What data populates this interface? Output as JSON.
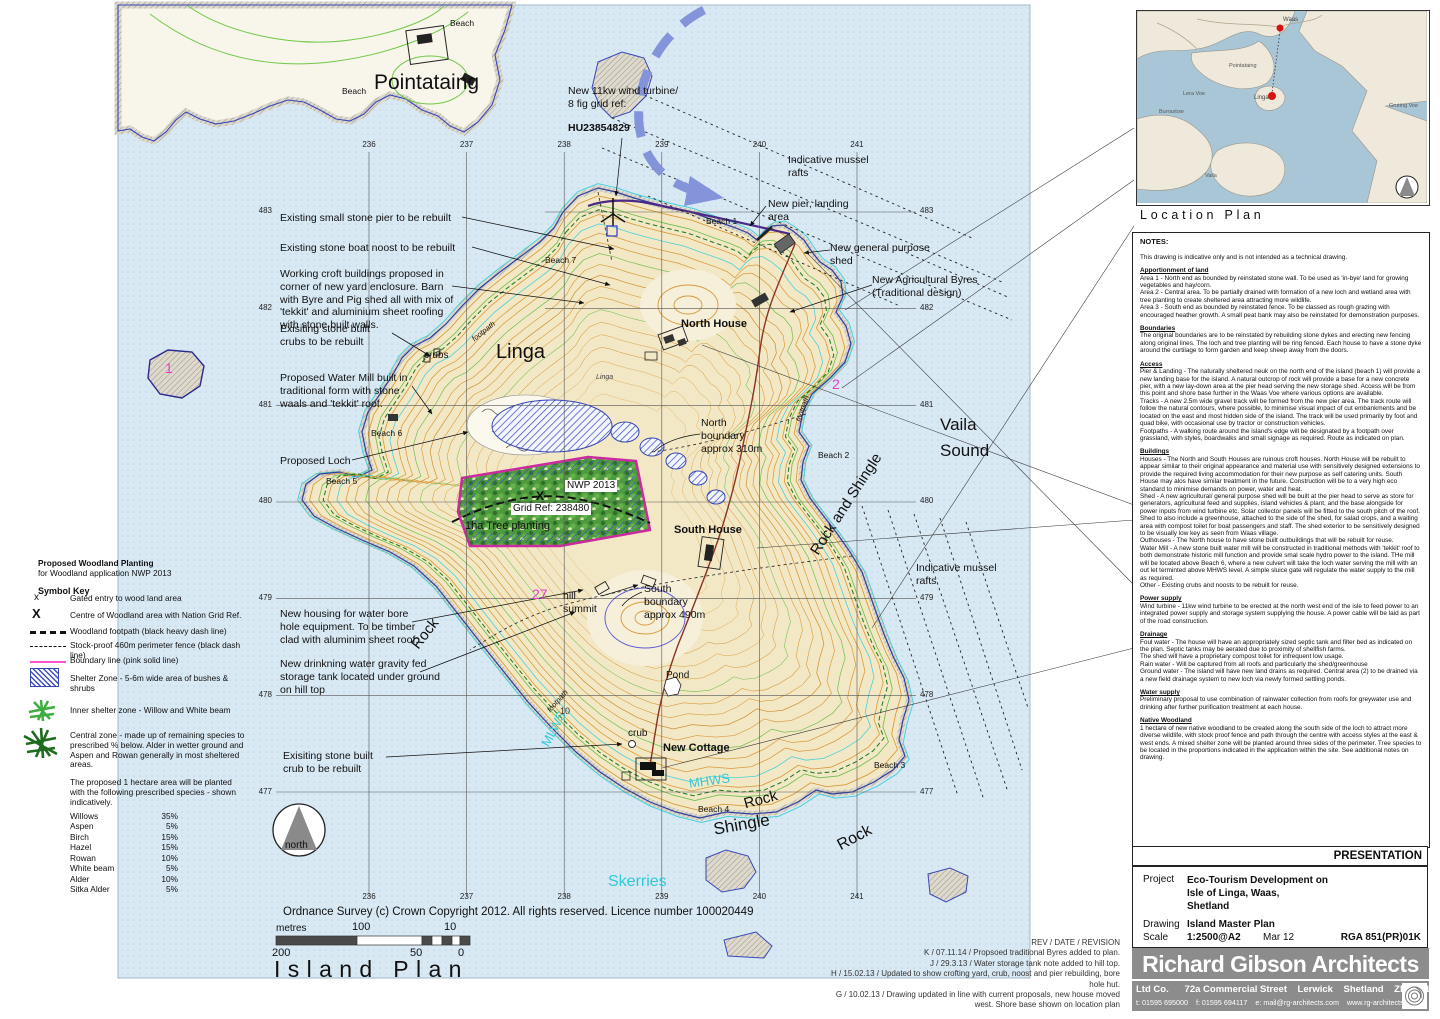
{
  "map": {
    "grid": {
      "cols": [
        "236",
        "237",
        "238",
        "239",
        "240",
        "241"
      ],
      "rows": [
        "483",
        "482",
        "481",
        "480",
        "479",
        "478",
        "477"
      ]
    },
    "labels": {
      "pier_rebuilt": "Existing small stone pier to be rebuilt",
      "noost_rebuilt": "Existing stone boat noost to be rebuilt",
      "croft_buildings": "Working croft buildings proposed in corner of new yard enclosure.  Barn with Byre and Pig shed all with mix of 'tekkit' and aluminium sheet roofing with stone built walls.",
      "crubs_rebuilt": "Exisiting stone built crubs to be rebuilt",
      "water_mill": "Proposed Water Mill built in traditional form with stone waals and 'tekkit' roof.",
      "proposed_loch": "Proposed Loch",
      "bore_hole": "New housing for water bore hole equipment. To be timber clad with aluminim sheet roof.",
      "storage_tank": "New drinkning water gravity fed storage tank located under ground on hill top",
      "crub_rebuilt": "Exisiting stone built crub to be rebuilt",
      "wind_turbine": "New 11kw wind turbine/\n8 fig grid ref:",
      "wind_turbine_ref": "HU23854829",
      "new_pier": "New pier, landing area",
      "general_shed": "New general purpose shed",
      "agri_byres": "New Agricultural  Byres\n(Traditional design)",
      "mussel_rafts": "Indicative mussel rafts",
      "pointataing": "Pointataing",
      "linga": "Linga",
      "linga_small": "Linga",
      "vaila_sound": "Vaila Sound",
      "north_house": "North House",
      "south_house": "South House",
      "new_cottage": "New Cottage",
      "north_boundary": "North boundary approx 310m",
      "south_boundary": "South boundary approx 490m",
      "hill_summit": "hill summit",
      "pond": "Pond",
      "crub": "crub",
      "crubs": "crubs",
      "beach1": "Beach 1",
      "beach2": "Beach 2",
      "beach3": "Beach 3",
      "beach4": "Beach 4",
      "beach5": "Beach 5",
      "beach6": "Beach 6",
      "beach7": "Beach 7",
      "beach": "Beach",
      "rock": "Rock",
      "shingle": "Shingle",
      "rock_shingle": "Rock and Shingle",
      "mlws": "MLWS",
      "mhws": "MHWS",
      "skerries": "Skerries",
      "footpath": "footpath",
      "num27": "27",
      "num2": "2",
      "num1": "1",
      "ten": "10",
      "nwp": "NWP 2013",
      "x_mark": "X",
      "grid_ref": "Grid Ref: 238480",
      "tree_planting": "1ha Tree planting"
    },
    "scalebar": {
      "unit": "metres",
      "m100": "100",
      "m10": "10",
      "m200": "200",
      "m50": "50",
      "m0": "0"
    },
    "compass": "north",
    "copyright": "Ordnance Survey (c) Crown Copyright 2012. All rights reserved. Licence number 100020449",
    "title": "Island Plan"
  },
  "key_block": {
    "title_l1": "Proposed Woodland Planting",
    "title_l2": "for Woodland application NWP 2013",
    "heading": "Symbol Key",
    "items": [
      {
        "sym": "x",
        "label": "Gated entry to wood land area"
      },
      {
        "sym": "X",
        "label": "Centre of Woodland area with Nation Grid Ref."
      },
      {
        "sym": "",
        "label": "Woodland footpath (black heavy dash line)"
      },
      {
        "sym": "",
        "label": "Stock-proof 460m perimeter fence (black dash line)"
      },
      {
        "sym": "",
        "label": "Boundary line (pink solid line)"
      },
      {
        "sym": "",
        "label": "Shelter Zone - 5-6m wide area of  bushes & shrubs"
      },
      {
        "sym": "",
        "label": "Inner shelter zone - Willow and White beam"
      },
      {
        "sym": "",
        "label": "Central zone - made up of remaining species to prescribed % below.  Alder in wetter ground and Aspen and Rowan generally in most sheltered areas."
      }
    ],
    "note": "The proposed  1 hectare area will be planted with the following prescribed species - shown indicatively.",
    "species": [
      {
        "name": "Willows",
        "pct": "35%"
      },
      {
        "name": "Aspen",
        "pct": "5%"
      },
      {
        "name": "Birch",
        "pct": "15%"
      },
      {
        "name": "Hazel",
        "pct": "15%"
      },
      {
        "name": "Rowan",
        "pct": "10%"
      },
      {
        "name": "White beam",
        "pct": "5%"
      },
      {
        "name": "Alder",
        "pct": "10%"
      },
      {
        "name": "Sitka Alder",
        "pct": "5%"
      }
    ]
  },
  "revisions": {
    "header": "REV  /  DATE  / REVISION",
    "lines": [
      "K / 07.11.14 / Propsoed traditional Byres added to plan.",
      "J / 29.3.13 / Water storage tank note added to hill top.",
      "H / 15.02.13 / Updated to show crofting yard, crub, noost and pier rebuilding, bore hole hut.",
      "G / 10.02.13 / Drawing updated in line with current proposals, new house moved west. Shore base shown on location plan"
    ]
  },
  "panel": {
    "location_plan": {
      "title": "Location Plan",
      "labels": {
        "waas": "Waas",
        "pointataing": "Pointataing",
        "linga": "Linga",
        "lera_voe": "Lera Voe",
        "burrastow": "Burrastow",
        "vaila": "Vaila",
        "gruting_voe": "Gruting Voe"
      }
    },
    "notes": {
      "title": "NOTES:",
      "intro": "This drawing is indicative only and is not intended as a technical drawing.",
      "sections": [
        {
          "h": "Apportionment of land",
          "b": "Area 1 - North end as bounded by reinstated stone wall.   To be used as 'in-bye' land for growing vegetables and hay/corn.\nArea 2 - Central area.  To be partially drained with formation of a new loch and wetland area with tree planting to create sheltered area attracting more wildlife.\nArea 3 - South end as bounded by reinstated fence.  To be classed as rough grazing with encouraged heather growth. A small peat bank may also be reinstated for demonstration purposes."
        },
        {
          "h": "Boundaries",
          "b": "The original boundaries are to be reinstated by rebuilding stone dykes and erecting new fencing along original lines.  The loch and tree planting will be ring fenced.  Each house to have a stone dyke around the curtilage to form garden and keep sheep away from the doors."
        },
        {
          "h": "Access",
          "b": "Pier & Landing - The naturally sheltered neuk on the north end of the island (beach 1) will provide a new landing base for the island.  A natural outcrop of rock will provide a base for a new concrete pier, with a new lay-down area at the pier head serving the new storage shed.  Access will be from this point and shore base further in the Waas Voe where various options are available.\nTracks - A new 2.5m wide gravel track will be formed from the new pier area.  The track route will follow the natural contours, where possible, to minimise visual impact of cut embankments and be located on the east and most hidden side of the island. The track will be used primarily by foot and quad bike, with occasional use by tractor or construction vehicles.\nFootpaths - A walking route around the island's edge will be designated by a footpath over grassland, with styles, boardwalks and small signage as required. Route as indicated on plan."
        },
        {
          "h": "Buildings",
          "b": "Houses - The North and South Houses are ruinous croft houses. North House will be rebuilt to appear similar to their original appearance and material use with sensitively designed extensions to provide the required living accommodation for their new purpose as self catering units.    South House may alos have similar treatment in the future.  Construction will be to a very high eco standard to minimise demands on power, water and heat.\nShed - A new agricultural/ general purpose shed will be built at the pier head to serve as store for generators, agricultural feed and supplies, island vehicles & plant,  and the base alongside for power inputs from wind turbine etc.  Solar collector panels will be fitted to the south pitch of the roof. Shed to also include  a greenhouse, attached to the side of the shed,  for salad crops, and a waiting area with compost toilet for boat passengers and staff.  The shed exterior to be  sensitively designed to be visually low key as seen from Waas village.\nOuthouses - The North house to have stone built outbuildings that will be rebuilt for reuse.\nWater Mill - A new stone built water mill will be constructed in traditional methods with 'tekkit' roof to both demonstrate historic mill function and provide smal scale hydro power to the island.  THe mill will be located above Beach 6, where a new culvert will take the loch water serving the mill with an out let terminted above MHWS level.  A simple sluice gate will regulate the water supply to the mill as required.\nOther - Existing crubs and noosts to be rebuilt for reuse."
        },
        {
          "h": "Power supply",
          "b": "Wind turbine - 11kw wind turbine to be erected at the north west end of the isle to feed power to an integrated power supply and storage system supplying the house. A power cable will be laid as part of the road construction."
        },
        {
          "h": "Drainage",
          "b": "Foul water - The house will have an appropriately sized septic tank and filter bed as indicated on the plan.   Septic tanks may be aerated due to proximity of shellfish farms.\nThe shed will have a proprietary compost toilet for infrequent low usage.\nRain water - Will be captured from all roofs and particularly the shed/greenhouse\nGround water - The island will have new land drains as required.  Central area (2) to be drained via a new field drainage system to new loch via newly formed settling ponds."
        },
        {
          "h": "Water supply",
          "b": "Preliminary proposal to use combination of rainwater collection from roofs for greywater use and drinking after further purification treatment at each house."
        },
        {
          "h": "Native Woodland",
          "b": "1 hectare of new native woodland to be created along the south side of the loch to attract more diverse wildlife, with stock proof fence and path through the centre with access styles at the east & west ends.  A mixed shelter zone will be planted around three sides of the perimeter.  Tree species to be located in the proportions indicated in the application within the site.  See additional notes on drawing."
        }
      ]
    },
    "presentation": "PRESENTATION",
    "titleblock": {
      "project_label": "Project",
      "project": "Eco-Tourism Development on\nIsle of Linga, Waas,\nShetland",
      "drawing_label": "Drawing",
      "drawing": "Island Master Plan",
      "scale_label": "Scale",
      "scale": "1:2500@A2",
      "date": "Mar 12",
      "ref": "RGA 851(PR)01K"
    },
    "footer": {
      "name": "Richard Gibson Architects",
      "line2": "Ltd Co.      72a Commercial Street    Lerwick    Shetland    ZE1 0DL",
      "line3": "t: 01595 695000    f: 01595 694117    e: mail@rg-architects.com    www.rg-architects.com"
    }
  }
}
